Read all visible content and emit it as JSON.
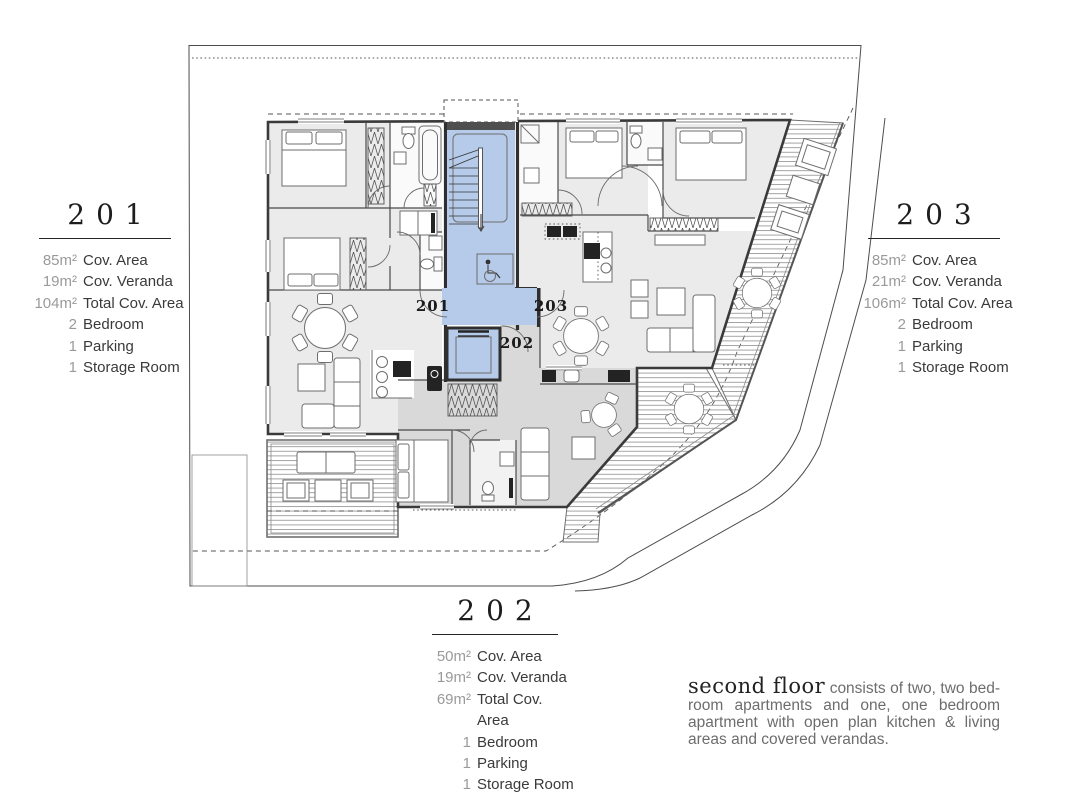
{
  "plan": {
    "apartment_labels": {
      "a201": "201",
      "a202": "202",
      "a203": "203"
    },
    "colors": {
      "room": "#ebebeb",
      "room_202": "#d9d9d9",
      "core_blue": "#b5cbe9",
      "wall": "#3a3a3a"
    }
  },
  "info_blocks": {
    "b201": {
      "title": "201",
      "rows": [
        {
          "value": "85m²",
          "label": "Cov. Area"
        },
        {
          "value": "19m²",
          "label": "Cov. Veranda"
        },
        {
          "value": "104m²",
          "label": "Total Cov. Area"
        },
        {
          "value": "2",
          "label": "Bedroom"
        },
        {
          "value": "1",
          "label": "Parking"
        },
        {
          "value": "1",
          "label": "Storage Room"
        }
      ]
    },
    "b202": {
      "title": "202",
      "rows": [
        {
          "value": "50m²",
          "label": "Cov. Area"
        },
        {
          "value": "19m²",
          "label": "Cov. Veranda"
        },
        {
          "value": "69m²",
          "label": "Total Cov. Area"
        },
        {
          "value": "1",
          "label": "Bedroom"
        },
        {
          "value": "1",
          "label": "Parking"
        },
        {
          "value": "1",
          "label": "Storage Room"
        }
      ]
    },
    "b203": {
      "title": "203",
      "rows": [
        {
          "value": "85m²",
          "label": "Cov. Area"
        },
        {
          "value": "21m²",
          "label": "Cov. Veranda"
        },
        {
          "value": "106m²",
          "label": "Total Cov. Area"
        },
        {
          "value": "2",
          "label": "Bedroom"
        },
        {
          "value": "1",
          "label": "Parking"
        },
        {
          "value": "1",
          "label": "Storage Room"
        }
      ]
    }
  },
  "description": {
    "lead": "second floor",
    "line1_rest": "consists of two, two bed-",
    "line2": "room apartments and one, one bedroom",
    "line3": "apartment with open plan kitchen & living",
    "line4": "areas and covered verandas."
  }
}
